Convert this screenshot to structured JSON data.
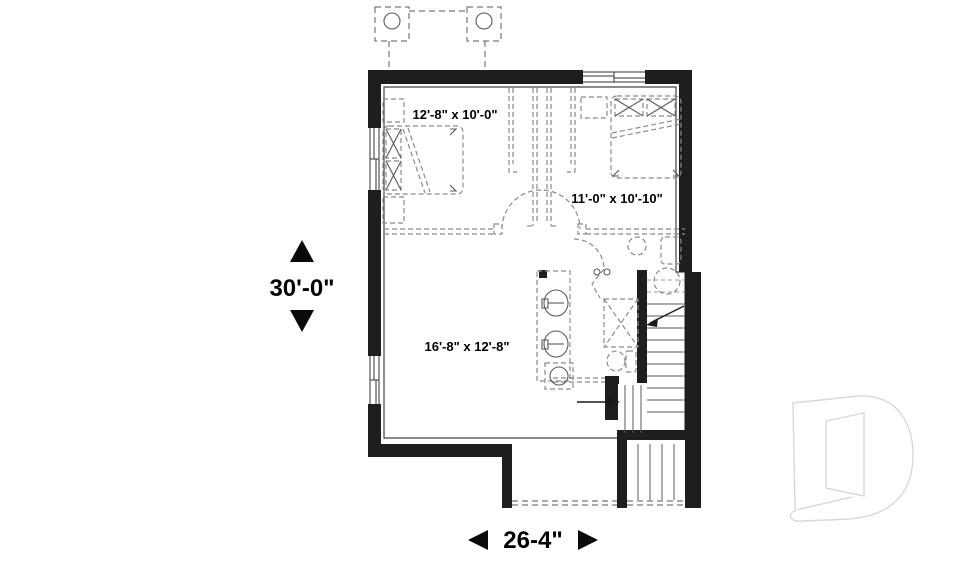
{
  "floor_plan": {
    "rooms": [
      {
        "label": "12'-8\" x 10'-0\""
      },
      {
        "label": "11'-0\" x 10'-10\""
      },
      {
        "label": "16'-8\" x 12'-8\""
      }
    ],
    "dimensions": {
      "vertical": "30'-0\"",
      "horizontal": "26-4\""
    },
    "logo_letter": "D",
    "colors": {
      "wall": "#1e1e1e",
      "thin_line": "#5a5a5a",
      "dashed_line": "#8b8b8b",
      "text": "#000000",
      "logo_outline": "#d8d8d8",
      "background": "#ffffff"
    }
  }
}
